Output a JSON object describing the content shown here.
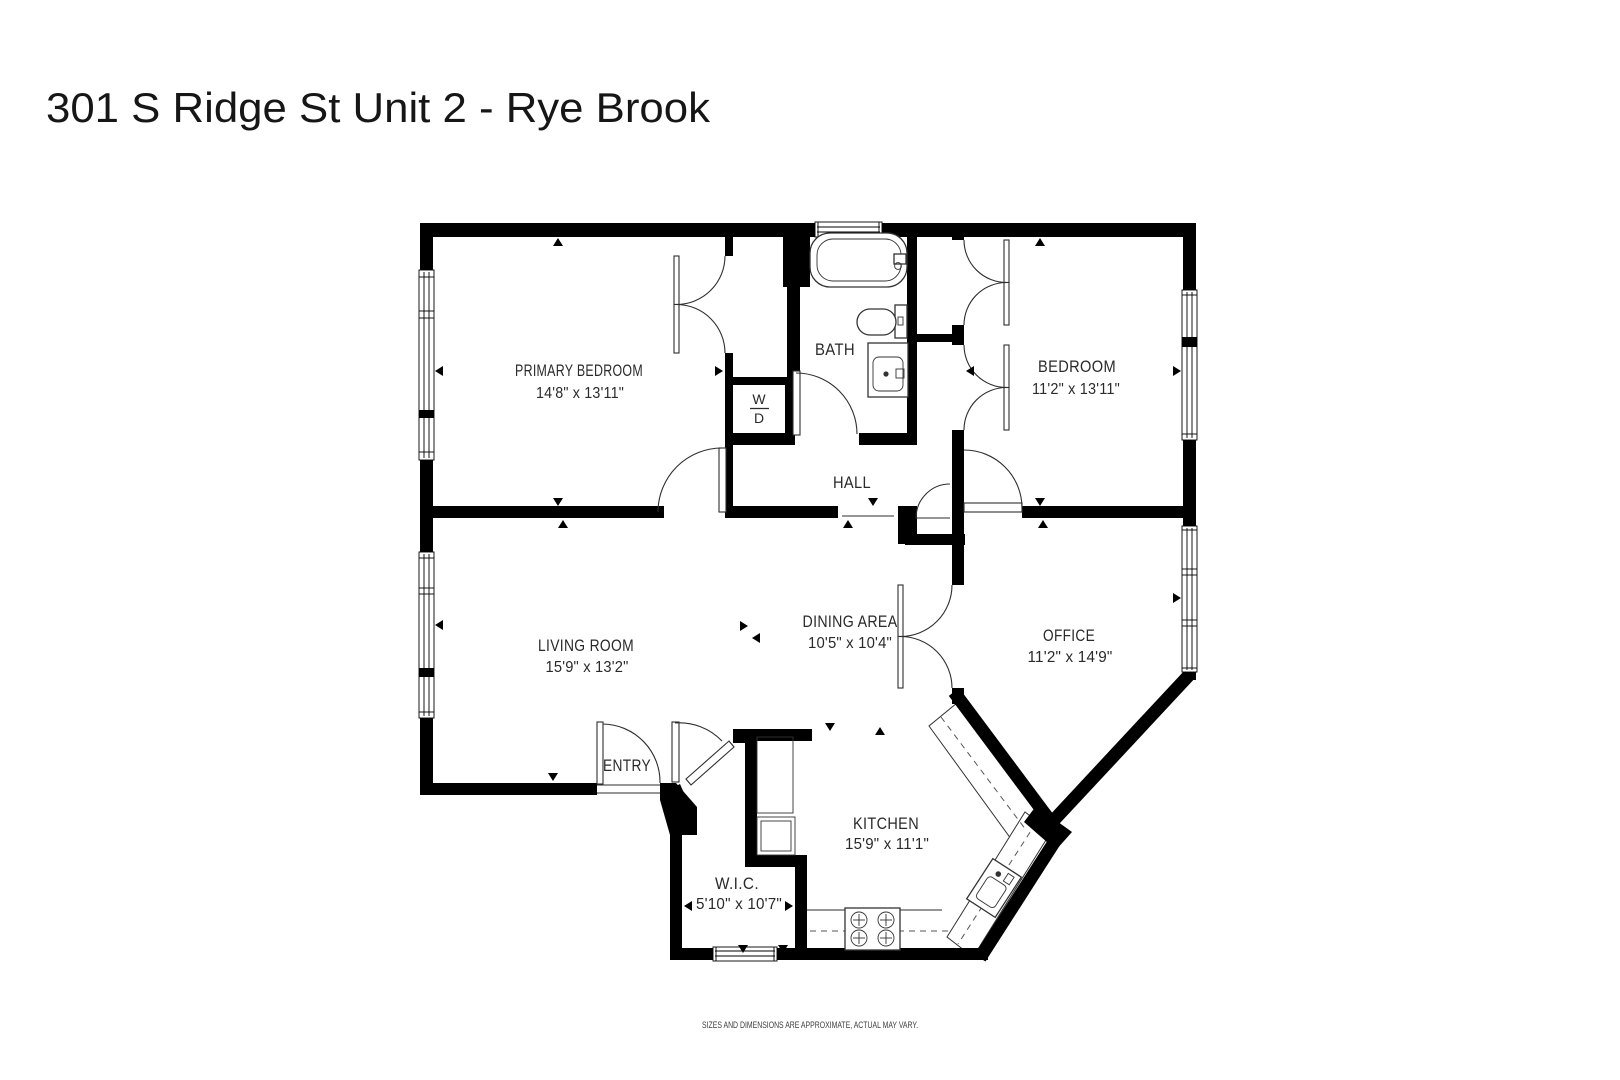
{
  "title": "301 S Ridge St Unit 2 - Rye Brook",
  "disclaimer": "SIZES AND DIMENSIONS ARE APPROXIMATE, ACTUAL MAY VARY.",
  "washer_dryer": {
    "washer": "W",
    "dryer": "D"
  },
  "rooms": {
    "primary_bedroom": {
      "name": "PRIMARY BEDROOM",
      "dims": "14'8\" x 13'11\""
    },
    "bath": {
      "name": "BATH"
    },
    "bedroom": {
      "name": "BEDROOM",
      "dims": "11'2\" x 13'11\""
    },
    "hall": {
      "name": "HALL"
    },
    "living_room": {
      "name": "LIVING ROOM",
      "dims": "15'9\" x 13'2\""
    },
    "dining_area": {
      "name": "DINING AREA",
      "dims": "10'5\" x 10'4\""
    },
    "office": {
      "name": "OFFICE",
      "dims": "11'2\" x 14'9\""
    },
    "entry": {
      "name": "ENTRY"
    },
    "kitchen": {
      "name": "KITCHEN",
      "dims": "15'9\" x 11'1\""
    },
    "wic": {
      "name": "W.I.C.",
      "dims": "5'10\" x 10'7\""
    }
  }
}
